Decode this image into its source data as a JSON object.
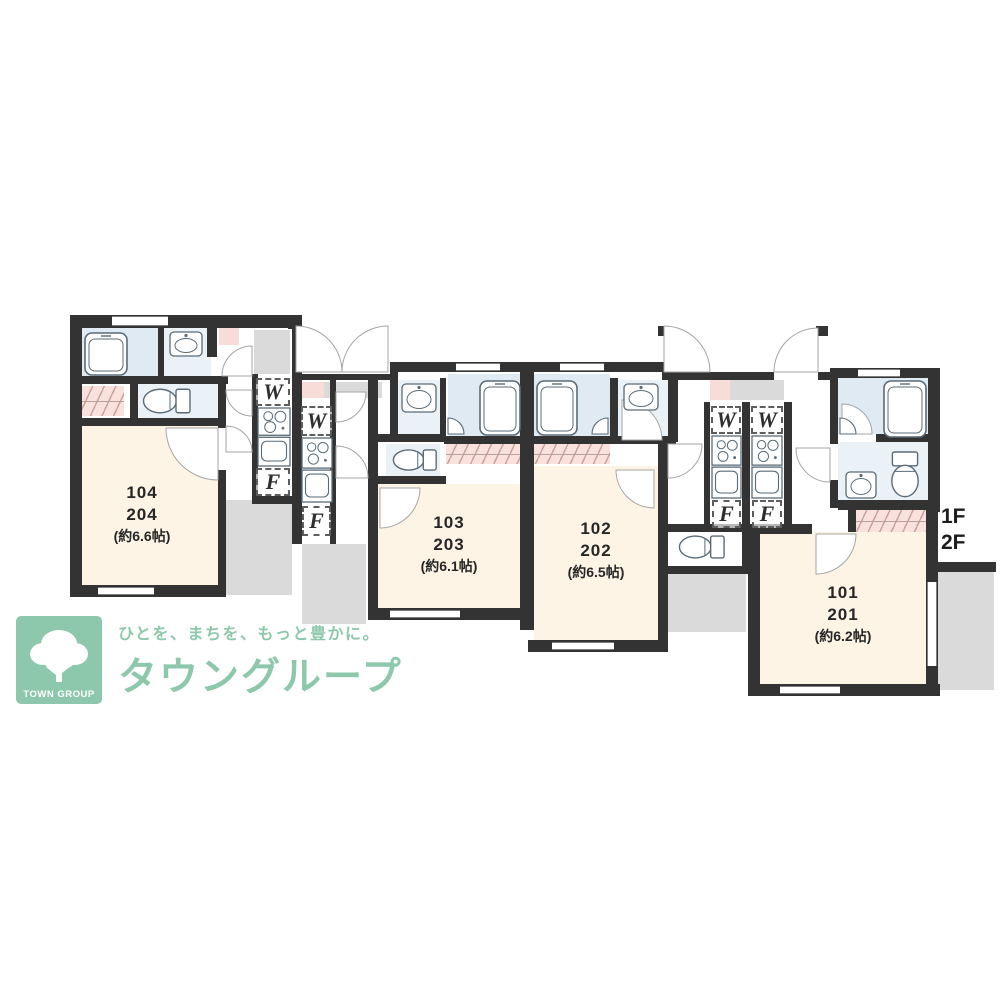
{
  "plan": {
    "floor_label": {
      "line1": "1F",
      "line2": "2F"
    },
    "units": [
      {
        "room_1f": "104",
        "room_2f": "204",
        "size": "(約6.6帖)"
      },
      {
        "room_1f": "103",
        "room_2f": "203",
        "size": "(約6.1帖)"
      },
      {
        "room_1f": "102",
        "room_2f": "202",
        "size": "(約6.5帖)"
      },
      {
        "room_1f": "101",
        "room_2f": "201",
        "size": "(約6.2帖)"
      }
    ],
    "appliance_labels": {
      "washer": "W",
      "fridge": "F"
    },
    "icons": [
      "bathtub-icon",
      "toilet-icon",
      "washbasin-icon",
      "kitchen-sink-stove-icon",
      "door-swing-icon",
      "corner-basin-icon",
      "tree-icon"
    ]
  },
  "logo": {
    "badge_text": "TOWN GROUP",
    "tagline": "ひとを、まちを、もっと豊かに。",
    "brand": "タウングループ"
  },
  "colors": {
    "wall": "#333333",
    "room_cream": "#fdf4e6",
    "bath_blue": "#dfeaf2",
    "accent_pink": "#f7dcd7",
    "porch_gray": "#dadada",
    "brand_green": "#8dc8ac",
    "fixture_line": "#5a6b77"
  }
}
